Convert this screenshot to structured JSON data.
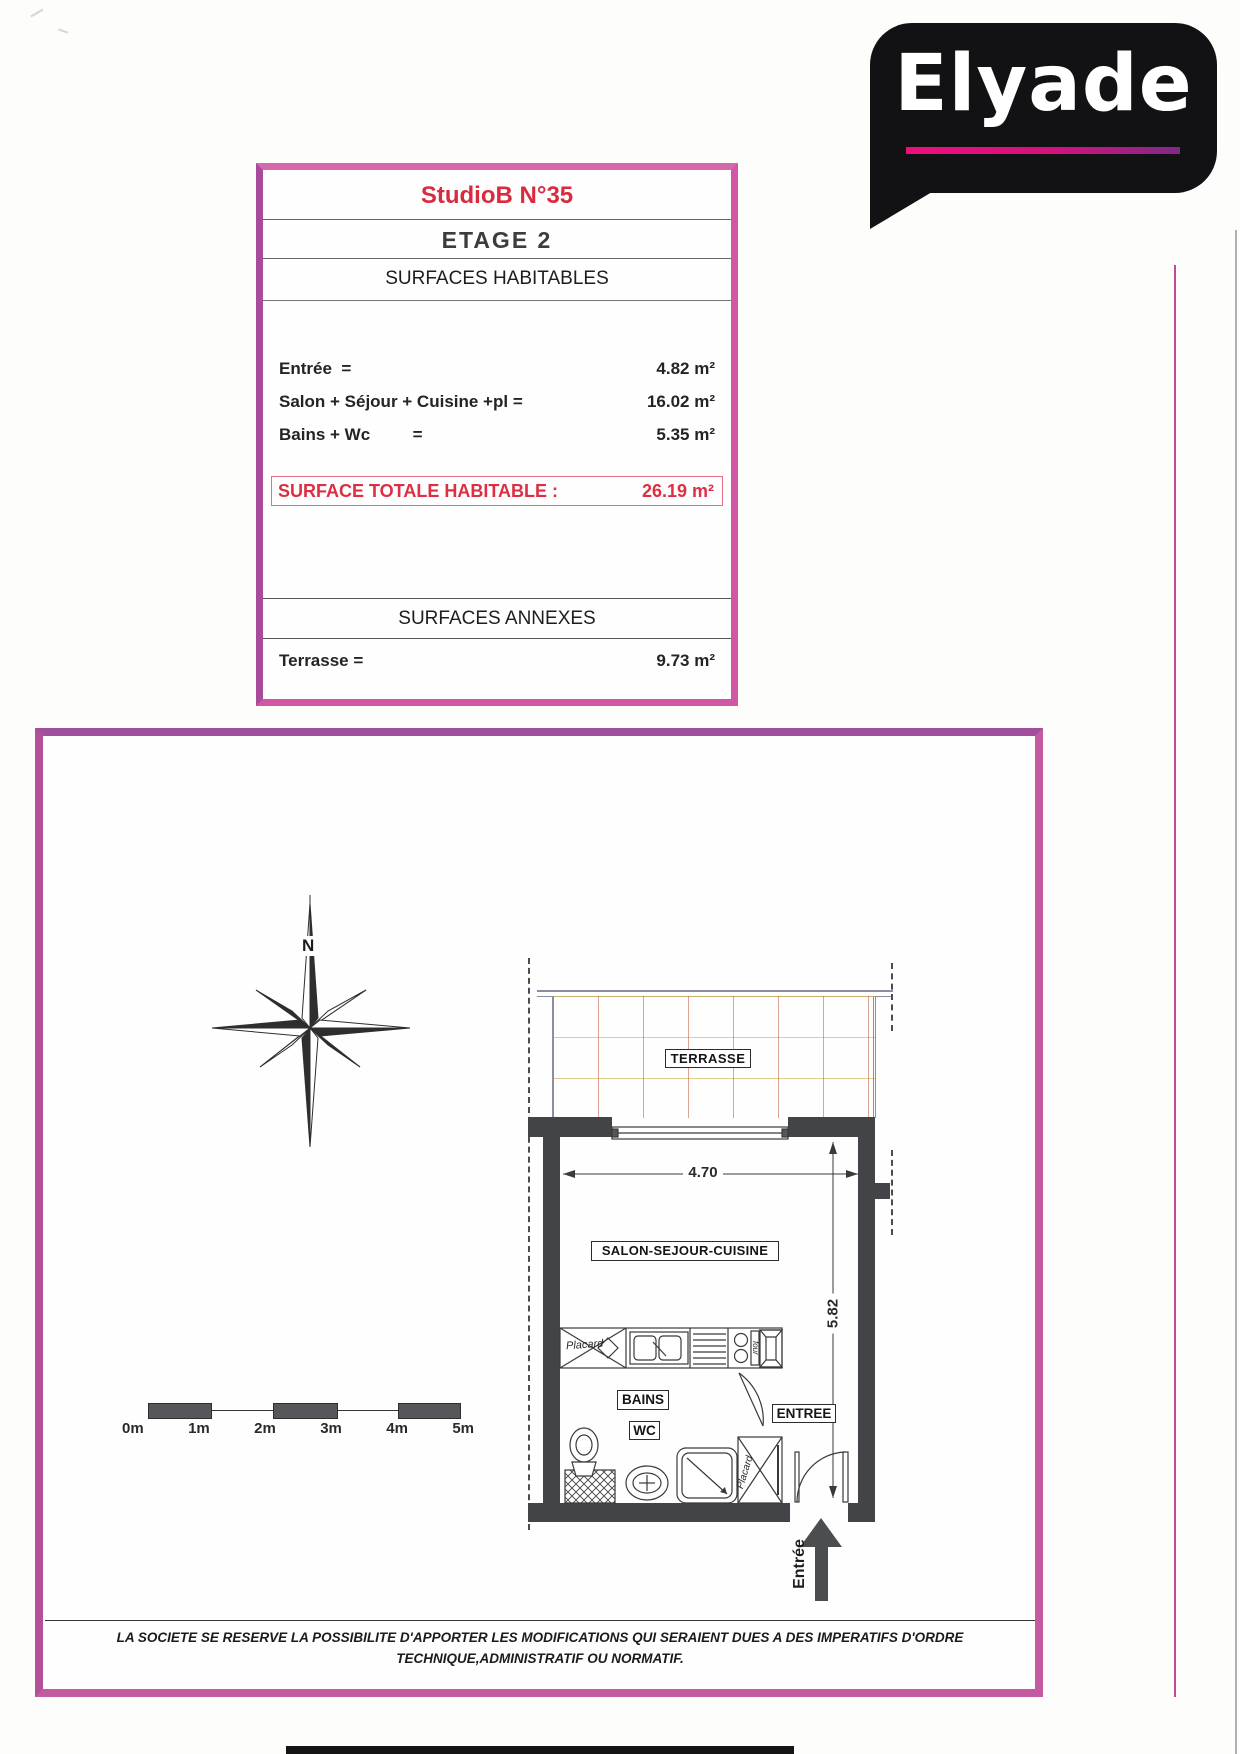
{
  "logo": {
    "text": "Elyade",
    "bg_color": "#121214",
    "underline_from": "#ee0f7d",
    "underline_to": "#7e2b85"
  },
  "info_box": {
    "title": "StudioB N°35",
    "floor": "ETAGE 2",
    "section_habitables": "SURFACES HABITABLES",
    "rows": [
      {
        "label": "Entrée  =",
        "value": "4.82 m²"
      },
      {
        "label": "Salon + Séjour + Cuisine +pl =",
        "value": "16.02 m²"
      },
      {
        "label": "Bains + Wc         =",
        "value": "5.35 m²"
      }
    ],
    "total_label": "SURFACE TOTALE HABITABLE :",
    "total_value": "26.19 m²",
    "section_annexes": "SURFACES ANNEXES",
    "annex_row": {
      "label": "Terrasse =",
      "value": "9.73 m²"
    }
  },
  "plan": {
    "north_label": "N",
    "labels": {
      "terrasse": "TERRASSE",
      "salon": "SALON-SEJOUR-CUISINE",
      "bains": "BAINS",
      "wc": "WC",
      "entree": "ENTREE",
      "placard_kitchen": "Placard",
      "placard_entry": "Placard",
      "four": "four",
      "entry_arrow": "Entrée"
    },
    "dimensions": {
      "width": "4.70",
      "depth": "5.82"
    },
    "scale": {
      "labels": [
        "0m",
        "1m",
        "2m",
        "3m",
        "4m",
        "5m"
      ]
    }
  },
  "disclaimer": {
    "line1": "LA SOCIETE SE RESERVE LA POSSIBILITE D'APPORTER LES MODIFICATIONS QUI SERAIENT DUES A DES IMPERATIFS D'ORDRE",
    "line2": "TECHNIQUE,ADMINISTRATIF OU NORMATIF."
  },
  "colors": {
    "border_pink": "#c45aa1",
    "accent_red": "#da2a3e",
    "wall_gray": "#434447"
  }
}
